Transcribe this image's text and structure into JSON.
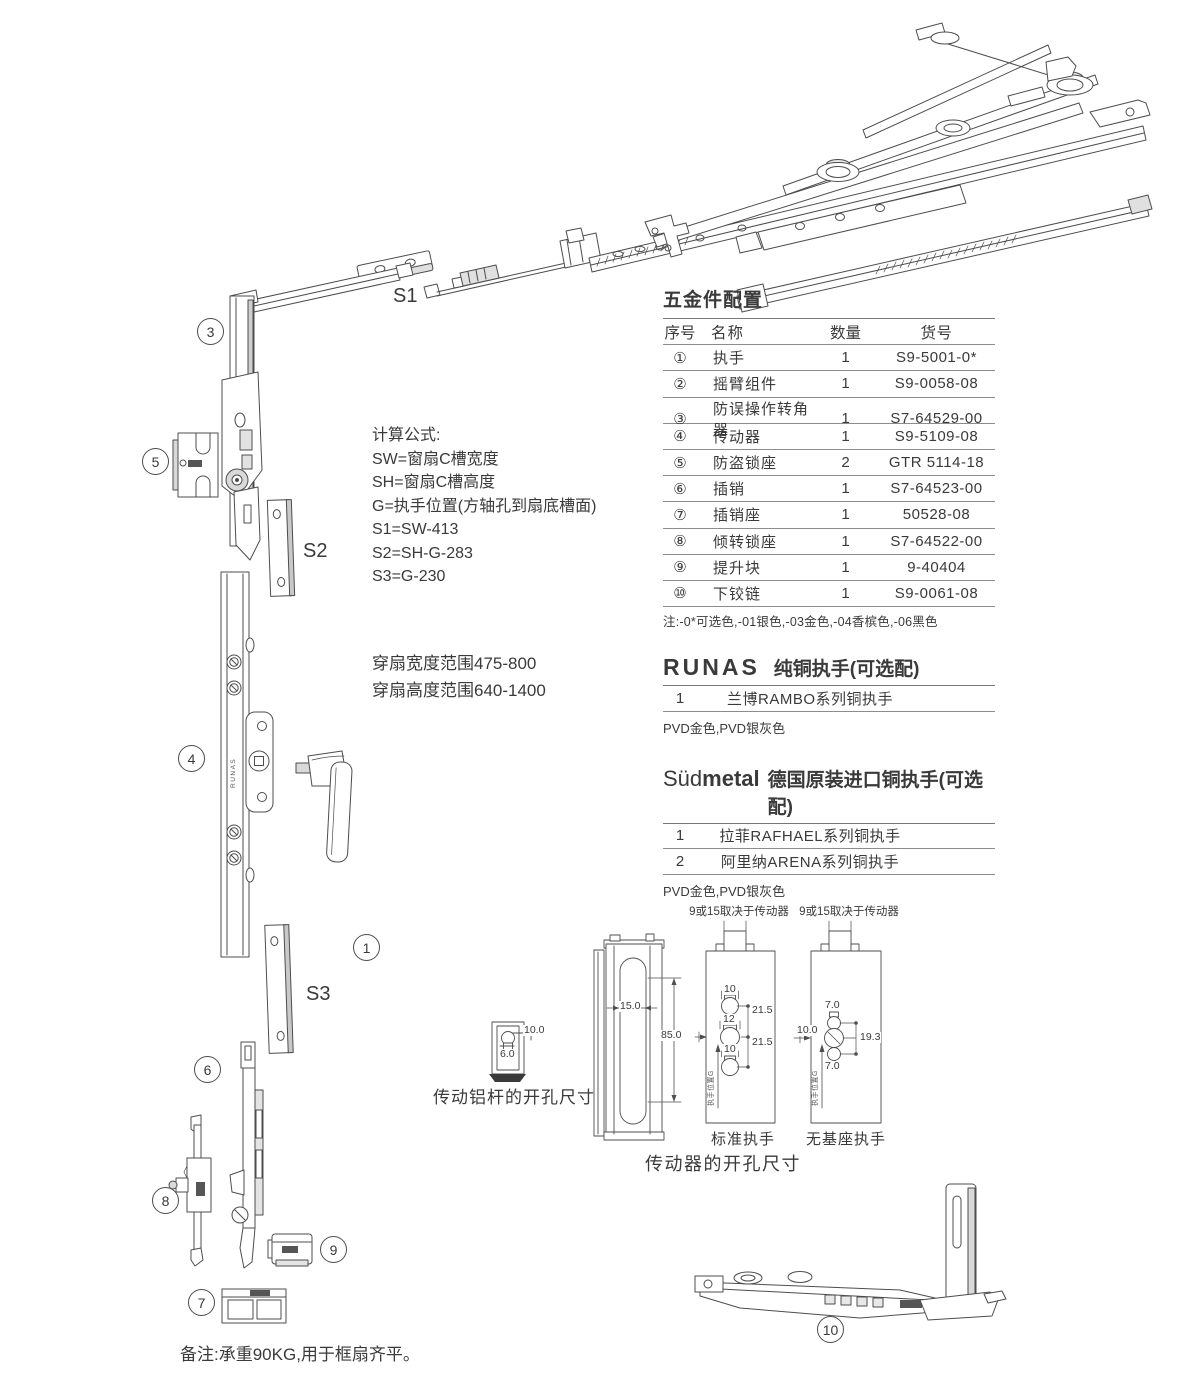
{
  "colors": {
    "line": "#4d4d4d",
    "text": "#3a3a3a",
    "rule": "#8c8c8c"
  },
  "parts_table": {
    "title": "五金件配置",
    "columns": [
      "序号",
      "名称",
      "数量",
      "货号"
    ],
    "rows": [
      {
        "no": "①",
        "name": "执手",
        "qty": "1",
        "code": "S9-5001-0*"
      },
      {
        "no": "②",
        "name": "摇臂组件",
        "qty": "1",
        "code": "S9-0058-08"
      },
      {
        "no": "③",
        "name": "防误操作转角器",
        "qty": "1",
        "code": "S7-64529-00"
      },
      {
        "no": "④",
        "name": "传动器",
        "qty": "1",
        "code": "S9-5109-08"
      },
      {
        "no": "⑤",
        "name": "防盗锁座",
        "qty": "2",
        "code": "GTR 5114-18"
      },
      {
        "no": "⑥",
        "name": "插销",
        "qty": "1",
        "code": "S7-64523-00"
      },
      {
        "no": "⑦",
        "name": "插销座",
        "qty": "1",
        "code": "50528-08"
      },
      {
        "no": "⑧",
        "name": "倾转锁座",
        "qty": "1",
        "code": "S7-64522-00"
      },
      {
        "no": "⑨",
        "name": "提升块",
        "qty": "1",
        "code": "9-40404"
      },
      {
        "no": "⑩",
        "name": "下铰链",
        "qty": "1",
        "code": "S9-0061-08"
      }
    ],
    "note": "注:-0*可选色,-01银色,-03金色,-04香槟色,-06黑色"
  },
  "runas": {
    "brand": "RUNAS",
    "title": "纯铜执手(可选配)",
    "rows": [
      {
        "no": "1",
        "name": "兰博RAMBO系列铜执手"
      }
    ],
    "note": "PVD金色,PVD银灰色"
  },
  "sudmetal": {
    "brand_light": "Süd",
    "brand_bold": "metal",
    "title": "德国原装进口铜执手(可选配)",
    "rows": [
      {
        "no": "1",
        "name": "拉菲RAFHAEL系列铜执手"
      },
      {
        "no": "2",
        "name": "阿里纳ARENA系列铜执手"
      }
    ],
    "note": "PVD金色,PVD银灰色"
  },
  "formulas": {
    "title": "计算公式:",
    "l1": "SW=窗扇C槽宽度",
    "l2": "SH=窗扇C槽高度",
    "l3": "G=执手位置(方轴孔到扇底槽面)",
    "l4": "S1=SW-413",
    "l5": "S2=SH-G-283",
    "l6": "S3=G-230"
  },
  "sash_range": {
    "line1": "穿扇宽度范围475-800",
    "line2": "穿扇高度范围640-1400"
  },
  "callouts": {
    "c1": "1",
    "c3": "3",
    "c4": "4",
    "c5": "5",
    "c6": "6",
    "c7": "7",
    "c8": "8",
    "c9": "9",
    "c10": "10"
  },
  "strip_labels": {
    "s1": "S1",
    "s2": "S2",
    "s3": "S3"
  },
  "bar_brand": "RUNAS",
  "drill_rod": {
    "caption": "传动铝杆的开孔尺寸",
    "dim_w": "10.0",
    "dim_h": "6.0"
  },
  "drill_gear": {
    "caption": "传动器的开孔尺寸",
    "profile": {
      "dim_slot": "15.0",
      "dim_len": "85.0"
    },
    "standard": {
      "header": "9或15取决于传动器",
      "label": "标准执手",
      "d_top": "10",
      "d_mid": "12",
      "d_bot": "10",
      "s_top": "21.5",
      "s_bot": "21.5",
      "axis": "执手位置G"
    },
    "nobase": {
      "header": "9或15取决于传动器",
      "label": "无基座执手",
      "d_top": "7.0",
      "d_left": "10.0",
      "d_right": "19.3",
      "d_bot": "7.0",
      "axis": "执手位置G"
    }
  },
  "footer_note": "备注:承重90KG,用于框扇齐平。"
}
